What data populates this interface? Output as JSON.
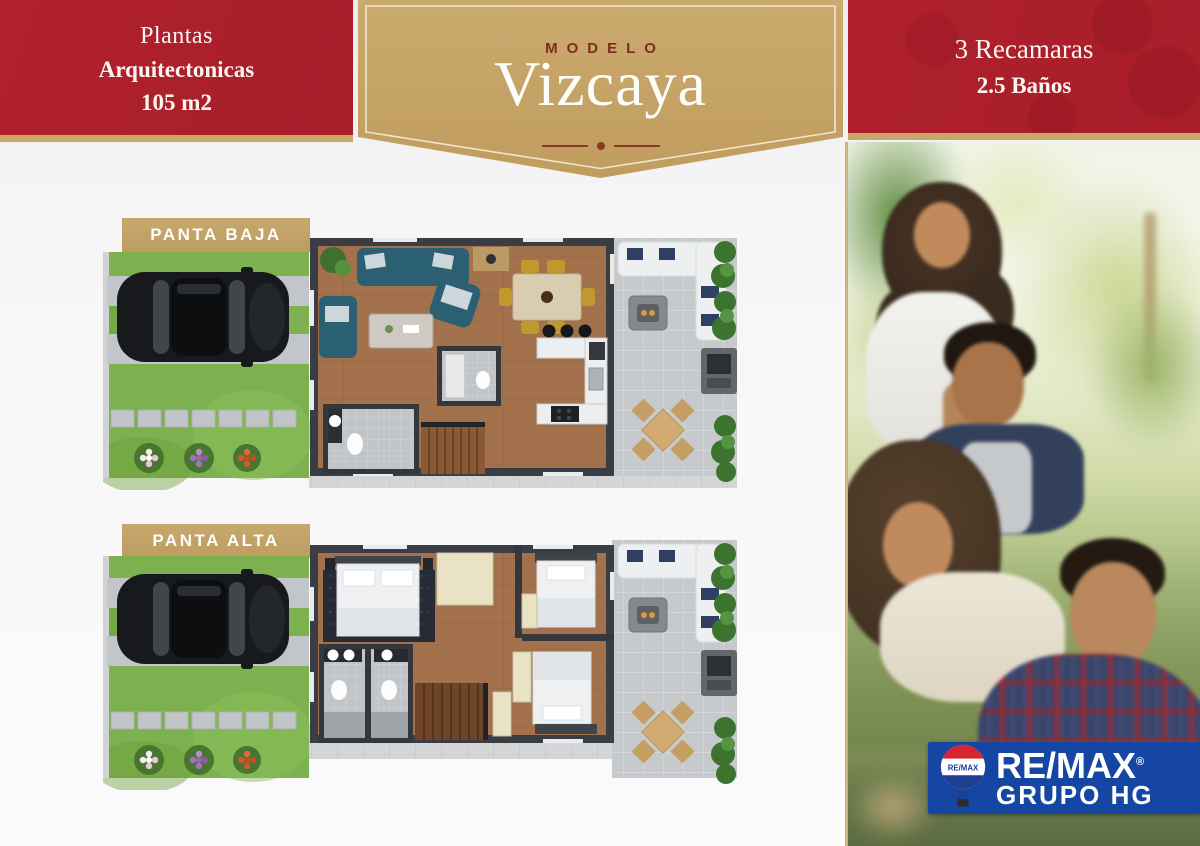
{
  "flyer": {
    "left_banner": {
      "title": "Plantas",
      "subtitle": "Arquitectonicas",
      "area": "105 m2"
    },
    "model_banner": {
      "eyebrow": "MODELO",
      "name": "Vizcaya"
    },
    "right_banner": {
      "bedrooms": "3 Recamaras",
      "bathrooms": "2.5 Baños"
    },
    "floor_plans": [
      {
        "label": "PANTA BAJA"
      },
      {
        "label": "PANTA ALTA"
      }
    ],
    "brand": {
      "name": "RE/MAX",
      "registered_mark": "®",
      "group": "GRUPO HG",
      "balloon_text": "RE/MAX"
    },
    "colors": {
      "banner_red": "#AB1F2B",
      "gold": "#C9A76B",
      "remax_blue": "#1546A4",
      "balloon_red": "#D6252E",
      "balloon_blue": "#1C3F94",
      "lawn_green": "#7DB04E",
      "wood_floor": "#A3714C"
    }
  }
}
